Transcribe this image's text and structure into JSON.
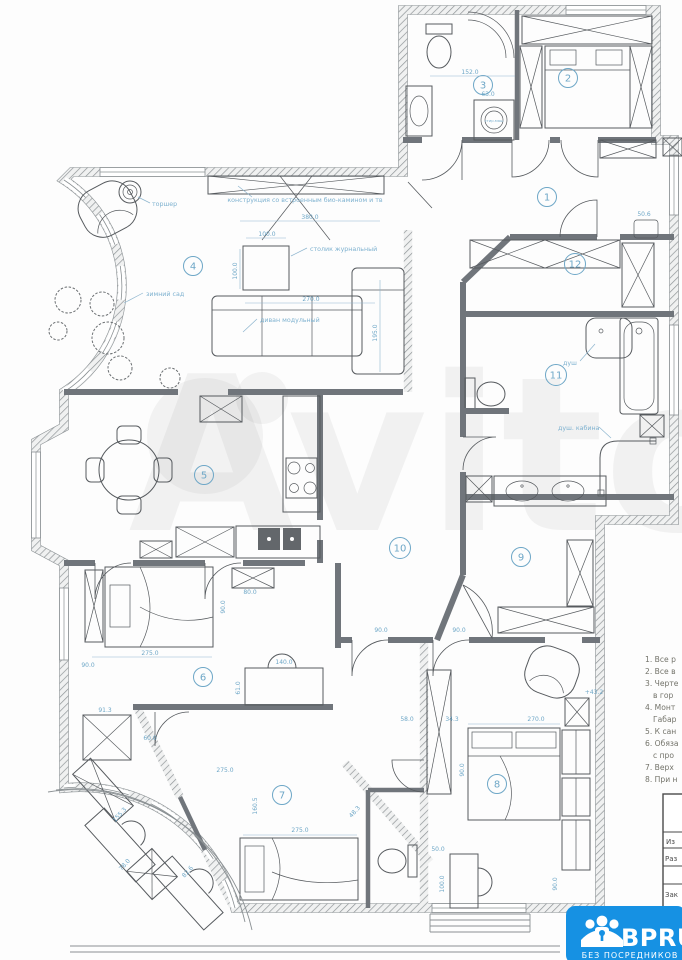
{
  "watermark": {
    "text": "Avito"
  },
  "logo": {
    "brand": "BPRU",
    "tagline": "БЕЗ ПОСРЕДНИКОВ"
  },
  "rooms": [
    "1",
    "2",
    "3",
    "4",
    "5",
    "6",
    "7",
    "8",
    "9",
    "10",
    "11",
    "12"
  ],
  "annotations": {
    "floor_lamp": "торшер",
    "tv_unit": "конструкция со встроенным био-камином и тв",
    "coffee_table": "столик журнальный",
    "winter_garden": "зимний сад",
    "sofa": "диван модульный",
    "washing_machine": "стир.маш",
    "shower": "душ",
    "shower_cabin": "душ. кабина"
  },
  "dims": [
    "380.0",
    "100.0",
    "100.0",
    "270.0",
    "195.0",
    "152.0",
    "63.0",
    "50.6",
    "80.0",
    "90.0",
    "275.0",
    "90.0",
    "140.0",
    "61.0",
    "91.3",
    "60.0",
    "275.0",
    "160.5",
    "48.3",
    "275.0",
    "155.3",
    "78.0",
    "82.6",
    "90.0",
    "90.0",
    "58.0",
    "34.3",
    "270.0",
    "90.0",
    "+43.2",
    "50.0",
    "100.0",
    "90.0"
  ],
  "notes": {
    "items": [
      "1. Все р",
      "2. Все в",
      "3. Черте",
      "в гор",
      "4. Монт",
      "Габар",
      "5. К сан",
      "6. Обяза",
      "с про",
      "7. Верх",
      "8. При н"
    ]
  },
  "title_block": {
    "rows": [
      "Из",
      "Раз",
      "Зак"
    ]
  }
}
